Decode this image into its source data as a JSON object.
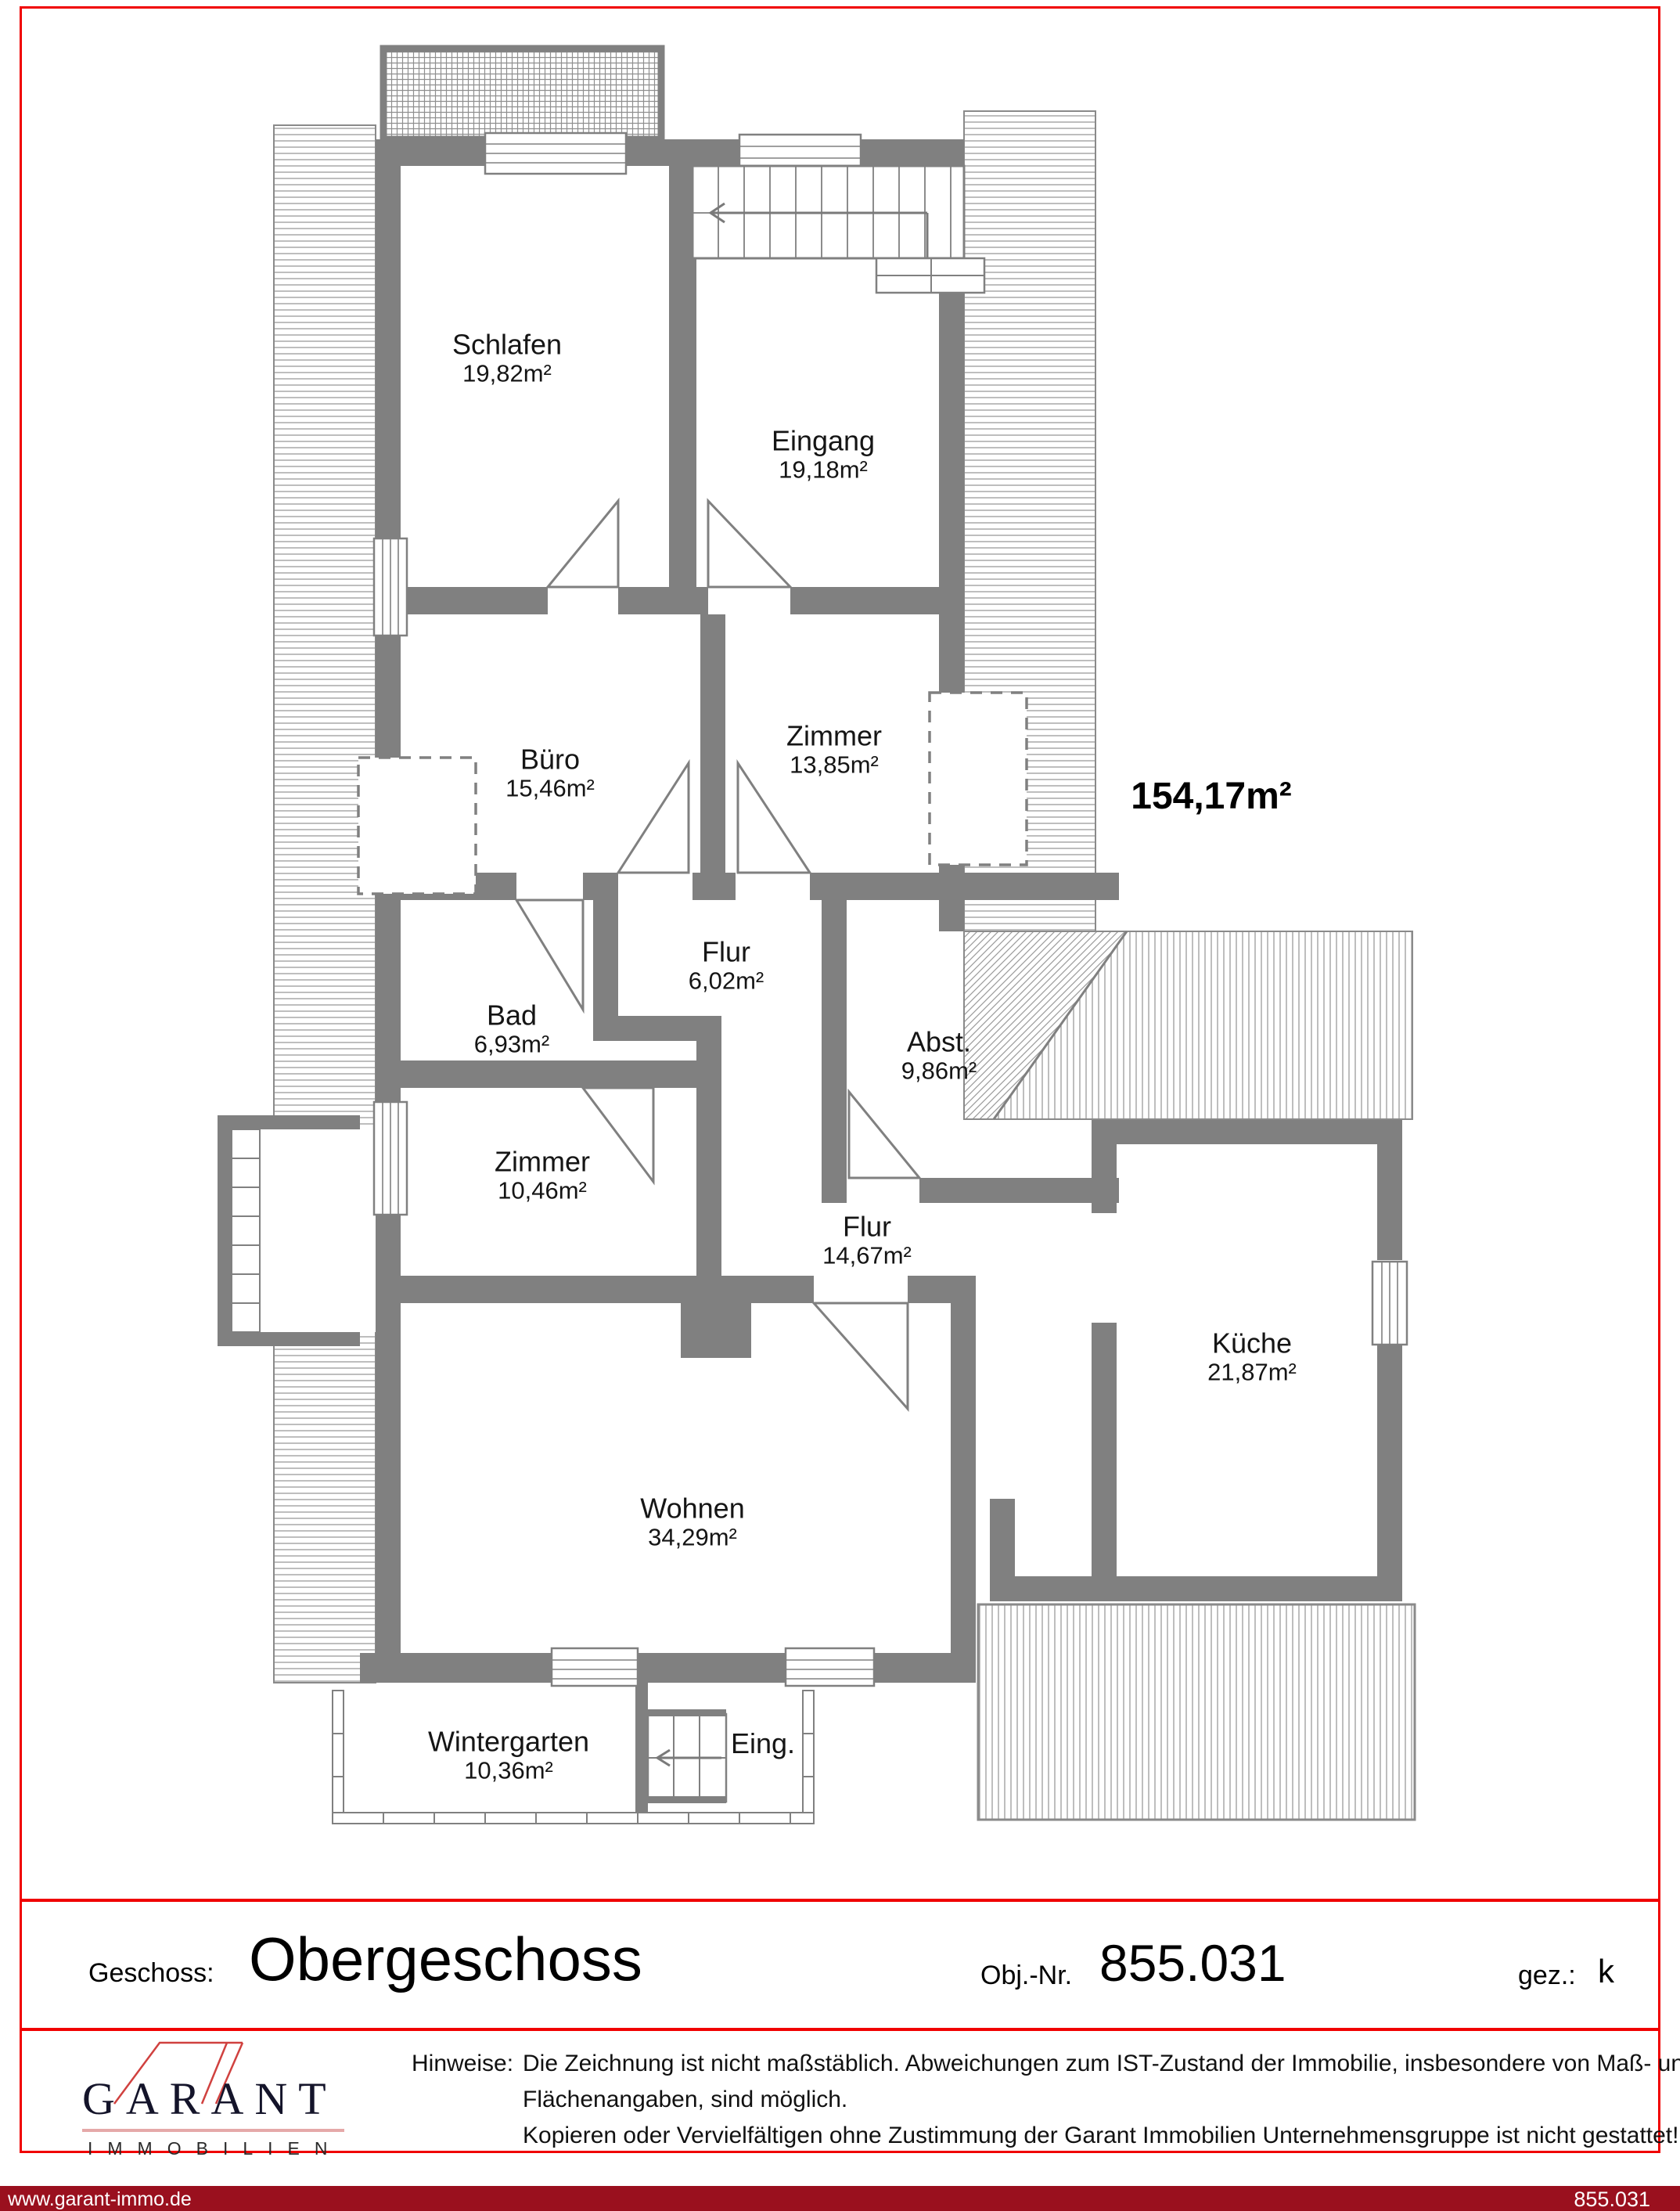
{
  "plan": {
    "total_area": "154,17m²",
    "rooms": [
      {
        "name": "Schlafen",
        "area": "19,82m²"
      },
      {
        "name": "Eingang",
        "area": "19,18m²"
      },
      {
        "name": "Büro",
        "area": "15,46m²"
      },
      {
        "name": "Zimmer",
        "area": "13,85m²"
      },
      {
        "name": "Flur",
        "area": "6,02m²"
      },
      {
        "name": "Bad",
        "area": "6,93m²"
      },
      {
        "name": "Abst.",
        "area": "9,86m²"
      },
      {
        "name": "Zimmer",
        "area": "10,46m²"
      },
      {
        "name": "Flur",
        "area": "14,67m²"
      },
      {
        "name": "Küche",
        "area": "21,87m²"
      },
      {
        "name": "Wohnen",
        "area": "34,29m²"
      },
      {
        "name": "Wintergarten",
        "area": "10,36m²"
      },
      {
        "name": "Eing.",
        "area": ""
      }
    ]
  },
  "title_block": {
    "geschoss_label": "Geschoss:",
    "geschoss_value": "Obergeschoss",
    "obj_label": "Obj.-Nr.",
    "obj_value": "855.031",
    "gez_label": "gez.:",
    "gez_value": "k"
  },
  "logo": {
    "name": "GARANT",
    "sub": "IMMOBILIEN"
  },
  "hinweise": {
    "label": "Hinweise:",
    "line1": "Die Zeichnung ist nicht maßstäblich. Abweichungen zum IST-Zustand der Immobilie, insbesondere von Maß- und",
    "line2": "Flächenangaben, sind möglich.",
    "line3": "Kopieren oder Vervielfältigen ohne Zustimmung der Garant Immobilien Unternehmensgruppe ist nicht gestattet!"
  },
  "footer": {
    "url": "www.garant-immo.de",
    "ref": "855.031"
  },
  "colors": {
    "wall": "#808080",
    "frame_red": "#f00000",
    "footer_bg": "#9a101e",
    "logo_red": "#d0413f"
  }
}
